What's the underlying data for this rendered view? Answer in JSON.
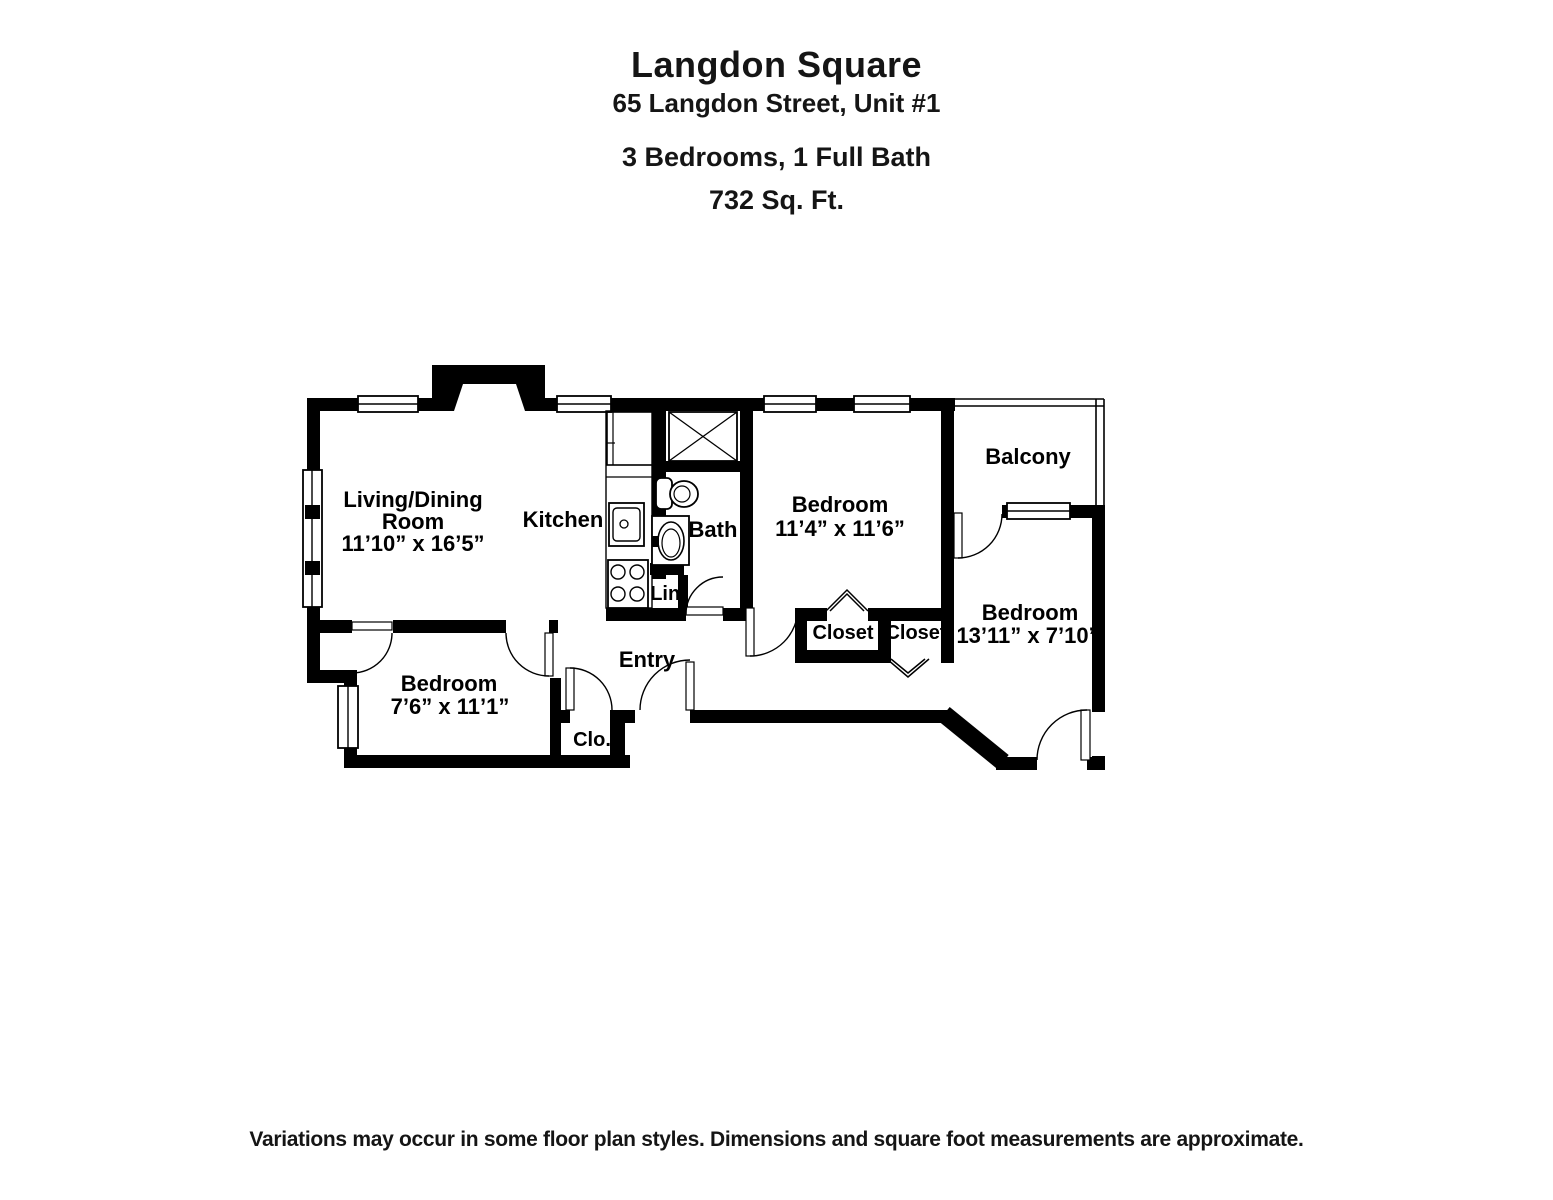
{
  "header": {
    "building_name": "Langdon Square",
    "address": "65 Langdon Street, Unit #1",
    "configuration": "3 Bedrooms, 1 Full Bath",
    "area": "732 Sq. Ft."
  },
  "floor_plan": {
    "rooms": {
      "living_dining": {
        "label_line1": "Living/Dining",
        "label_line2": "Room",
        "dimensions": "11’10” x 16’5”"
      },
      "kitchen": {
        "label": "Kitchen"
      },
      "bath": {
        "label": "Bath"
      },
      "linen": {
        "label": "Lin."
      },
      "bedroom_middle": {
        "label": "Bedroom",
        "dimensions": "11’4” x 11’6”"
      },
      "balcony": {
        "label": "Balcony"
      },
      "bedroom_right": {
        "label": "Bedroom",
        "dimensions": "13’11” x 7’10”"
      },
      "closet_a": {
        "label": "Closet"
      },
      "closet_b": {
        "label": "Closet"
      },
      "bedroom_lower": {
        "label": "Bedroom",
        "dimensions": "7’6” x 11’1”"
      },
      "entry_closet": {
        "label": "Clo."
      },
      "entry": {
        "label": "Entry"
      }
    }
  },
  "footer": {
    "disclaimer": "Variations may occur in some floor plan styles. Dimensions and square foot measurements are approximate."
  },
  "colors": {
    "walls": "#000000",
    "background": "#ffffff",
    "text": "#000000"
  }
}
